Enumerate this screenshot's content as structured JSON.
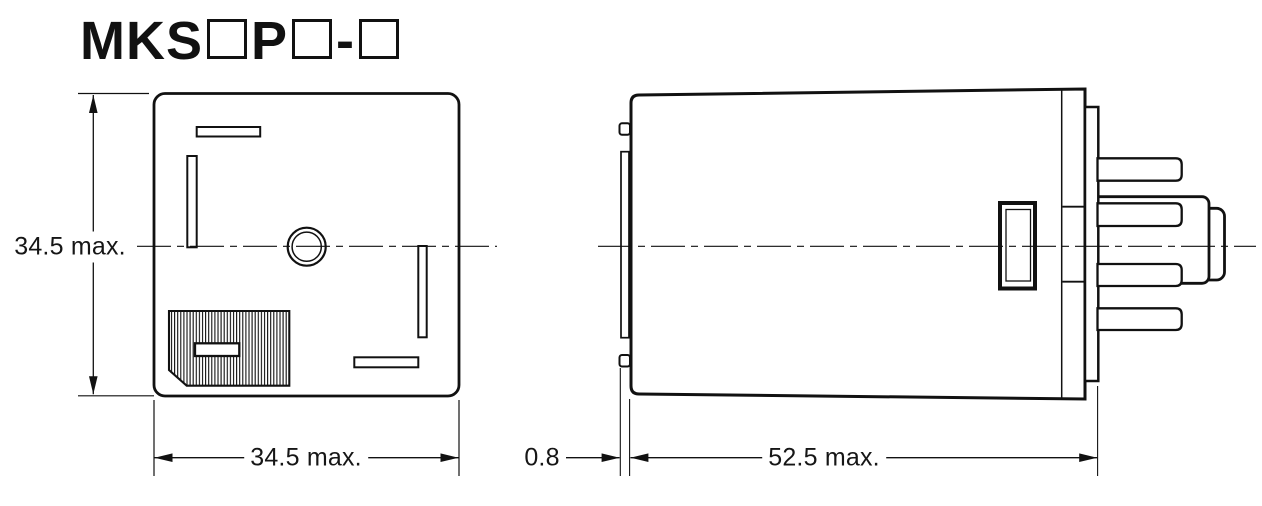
{
  "title": {
    "prefix": "MKS",
    "mid": "P",
    "hyphen": "-"
  },
  "dimensions": {
    "front_height": "34.5 max.",
    "front_width": "34.5 max.",
    "side_offset": "0.8",
    "side_length": "52.5 max."
  },
  "colors": {
    "line": "#111111",
    "background": "#ffffff"
  }
}
